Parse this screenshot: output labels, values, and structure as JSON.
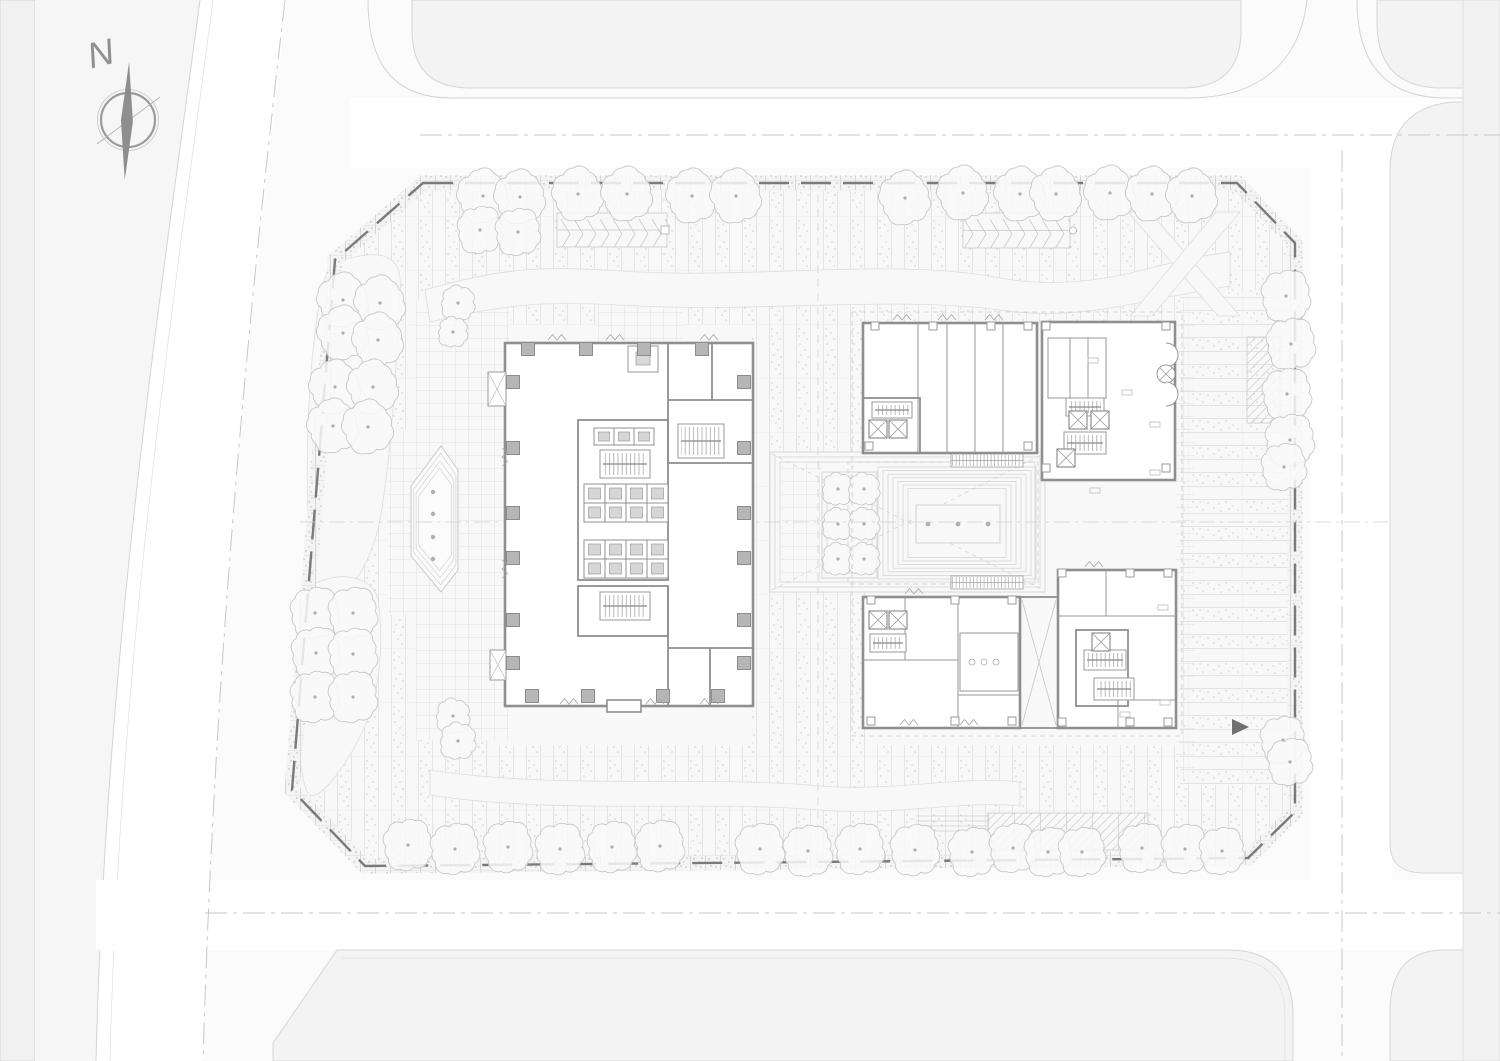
{
  "compass": {
    "label": "N"
  },
  "palette": {
    "background": "#fbfbfb",
    "road": "#ffffff",
    "parcel": "#f3f3f3",
    "site": "#f8f8f8",
    "wall": "#8f8f8f",
    "column": "#b6b6b6",
    "boundary_dash": "#7a7a7a",
    "tree_stroke": "#c8c8c8",
    "needle": "#8e8e8e",
    "stipple": "#bdbdbd",
    "axis": "#c9c9c9"
  },
  "boundary_points": "423,183 1237,183 1295,243 1295,812 1248,858 365,866 292,790 335,260",
  "entry_arrow_points": "1232,719 1249,727 1232,735",
  "trees": {
    "radius_default": 25,
    "groups": {
      "top_row": [
        [
          483,
          196
        ],
        [
          520,
          197
        ],
        [
          578,
          194
        ],
        [
          627,
          194
        ],
        [
          692,
          196
        ],
        [
          736,
          196
        ],
        [
          905,
          198
        ],
        [
          963,
          193
        ],
        [
          1020,
          194
        ],
        [
          1056,
          194
        ],
        [
          1110,
          193
        ],
        [
          1152,
          194
        ],
        [
          1192,
          196
        ]
      ],
      "second_row": [
        [
          480,
          230,
          22
        ],
        [
          518,
          232,
          22
        ]
      ],
      "nw_lawn": [
        [
          343,
          300
        ],
        [
          380,
          303
        ],
        [
          343,
          333
        ],
        [
          378,
          340
        ],
        [
          335,
          387
        ],
        [
          373,
          387
        ],
        [
          333,
          426
        ],
        [
          368,
          427
        ]
      ],
      "nw_small": [
        [
          458,
          303,
          16
        ],
        [
          453,
          332,
          14
        ]
      ],
      "sw_lawn": [
        [
          315,
          613,
          24
        ],
        [
          353,
          613,
          24
        ],
        [
          316,
          653,
          24
        ],
        [
          353,
          654,
          24
        ],
        [
          315,
          697,
          24
        ],
        [
          353,
          697,
          24
        ]
      ],
      "sw_small": [
        [
          453,
          716,
          16
        ],
        [
          458,
          741,
          17
        ]
      ],
      "bottom_row": [
        [
          408,
          845,
          24
        ],
        [
          455,
          849,
          24
        ],
        [
          508,
          847,
          24
        ],
        [
          560,
          849,
          24
        ],
        [
          612,
          847,
          24
        ],
        [
          660,
          846,
          24
        ],
        [
          760,
          849,
          24
        ],
        [
          808,
          851,
          24
        ],
        [
          860,
          849,
          24
        ],
        [
          915,
          850,
          24
        ],
        [
          972,
          852,
          23
        ],
        [
          1013,
          848,
          23
        ],
        [
          1048,
          852,
          23
        ],
        [
          1082,
          852,
          23
        ],
        [
          1142,
          848,
          23
        ],
        [
          1185,
          849,
          23
        ],
        [
          1222,
          851,
          22
        ]
      ],
      "east_column": [
        [
          1286,
          296,
          24
        ],
        [
          1291,
          344,
          24
        ],
        [
          1287,
          394,
          24
        ],
        [
          1290,
          440,
          24
        ],
        [
          1284,
          467,
          22
        ],
        [
          1283,
          740,
          22
        ],
        [
          1290,
          762,
          22
        ]
      ],
      "courtyard": [
        [
          838,
          489,
          15
        ],
        [
          864,
          489,
          15
        ],
        [
          838,
          524,
          15
        ],
        [
          864,
          524,
          15
        ],
        [
          838,
          559,
          15
        ],
        [
          864,
          559,
          15
        ]
      ]
    }
  },
  "tower_columns": {
    "size": 13,
    "top": {
      "y": 349,
      "xs": [
        528,
        586,
        644,
        702
      ]
    },
    "bottom": {
      "y": 696,
      "xs": [
        532,
        588,
        663,
        718
      ]
    },
    "left": {
      "x": 513,
      "ys": [
        382,
        448,
        513,
        558,
        620,
        663
      ]
    },
    "right": {
      "x": 744,
      "ys": [
        382,
        448,
        513,
        558,
        620,
        663
      ]
    }
  },
  "small_columns": [
    [
      875,
      326
    ],
    [
      933,
      326
    ],
    [
      991,
      326
    ],
    [
      1028,
      326
    ],
    [
      869,
      446
    ],
    [
      1028,
      446
    ],
    [
      871,
      600
    ],
    [
      955,
      600
    ],
    [
      1012,
      600
    ],
    [
      871,
      721
    ],
    [
      955,
      721
    ],
    [
      1012,
      721
    ],
    [
      1062,
      573
    ],
    [
      1130,
      573
    ],
    [
      1168,
      573
    ],
    [
      1062,
      722
    ],
    [
      1130,
      722
    ],
    [
      1168,
      722
    ],
    [
      1046,
      326
    ],
    [
      1046,
      468
    ],
    [
      1166,
      326
    ],
    [
      1166,
      468
    ]
  ],
  "elevator_banks": [
    {
      "x": 584,
      "y": 484,
      "cols": 4,
      "rows": 2,
      "cw": 21,
      "ch": 19
    },
    {
      "x": 584,
      "y": 540,
      "cols": 4,
      "rows": 2,
      "cw": 21,
      "ch": 19
    },
    {
      "x": 594,
      "y": 428,
      "cols": 3,
      "rows": 1,
      "cw": 20,
      "ch": 17
    }
  ],
  "stairs": [
    {
      "x": 600,
      "y": 450,
      "w": 50,
      "h": 28
    },
    {
      "x": 600,
      "y": 592,
      "w": 50,
      "h": 28
    },
    {
      "x": 678,
      "y": 424,
      "w": 46,
      "h": 34
    },
    {
      "x": 872,
      "y": 402,
      "w": 40,
      "h": 16
    },
    {
      "x": 1066,
      "y": 398,
      "w": 38,
      "h": 18
    },
    {
      "x": 1064,
      "y": 432,
      "w": 42,
      "h": 22
    },
    {
      "x": 870,
      "y": 634,
      "w": 36,
      "h": 18
    },
    {
      "x": 1084,
      "y": 650,
      "w": 42,
      "h": 20
    },
    {
      "x": 1094,
      "y": 678,
      "w": 40,
      "h": 22
    }
  ],
  "x_elevators": {
    "size": 18,
    "cells": [
      [
        869,
        420
      ],
      [
        889,
        420
      ],
      [
        1069,
        411
      ],
      [
        1091,
        411
      ],
      [
        869,
        611
      ],
      [
        889,
        611
      ],
      [
        1092,
        633
      ],
      [
        1057,
        449
      ]
    ]
  },
  "escalators": [
    [
      951,
      454,
      72,
      13
    ],
    [
      951,
      576,
      72,
      13
    ]
  ],
  "terrace": {
    "x": 878,
    "y": 467,
    "w": 158,
    "h": 112,
    "steps": 7,
    "inset": 5,
    "inner": {
      "x": 916,
      "y": 505,
      "w": 84,
      "h": 38
    },
    "dot_y": 524,
    "dot_xs": [
      928,
      958,
      988
    ],
    "dot_r": 2.4
  },
  "water_feature": {
    "outline": [
      [
        411,
        486
      ],
      [
        411,
        556
      ],
      [
        441,
        592
      ],
      [
        458,
        570
      ],
      [
        458,
        470
      ],
      [
        441,
        446
      ]
    ],
    "inset_factors": [
      0.9,
      0.8,
      0.7
    ],
    "dot_x": 433,
    "dot_ys": [
      492,
      514,
      537,
      559
    ],
    "dot_r": 2.2
  },
  "chevron_ramps": [
    {
      "x": 557,
      "y": 213,
      "w": 110,
      "h": 34,
      "end": "square"
    },
    {
      "x": 963,
      "y": 213,
      "w": 107,
      "h": 35,
      "end": "circle"
    }
  ],
  "door_symbols": [
    [
      548,
      340,
      "h"
    ],
    [
      606,
      340,
      "h"
    ],
    [
      700,
      340,
      "h"
    ],
    [
      502,
      448,
      "v"
    ],
    [
      502,
      560,
      "v"
    ],
    [
      560,
      704,
      "h"
    ],
    [
      646,
      704,
      "h"
    ],
    [
      700,
      704,
      "h"
    ],
    [
      893,
      320,
      "h"
    ],
    [
      938,
      320,
      "h"
    ],
    [
      985,
      320,
      "h"
    ],
    [
      900,
      725,
      "h"
    ],
    [
      960,
      725,
      "h"
    ],
    [
      1085,
      567,
      "h"
    ],
    [
      905,
      594,
      "h"
    ]
  ],
  "furniture_marks": [
    [
      1088,
      358
    ],
    [
      1122,
      390
    ],
    [
      1150,
      422
    ],
    [
      1150,
      470
    ],
    [
      1090,
      488
    ],
    [
      1158,
      605
    ],
    [
      1160,
      700
    ],
    [
      1120,
      712
    ]
  ]
}
